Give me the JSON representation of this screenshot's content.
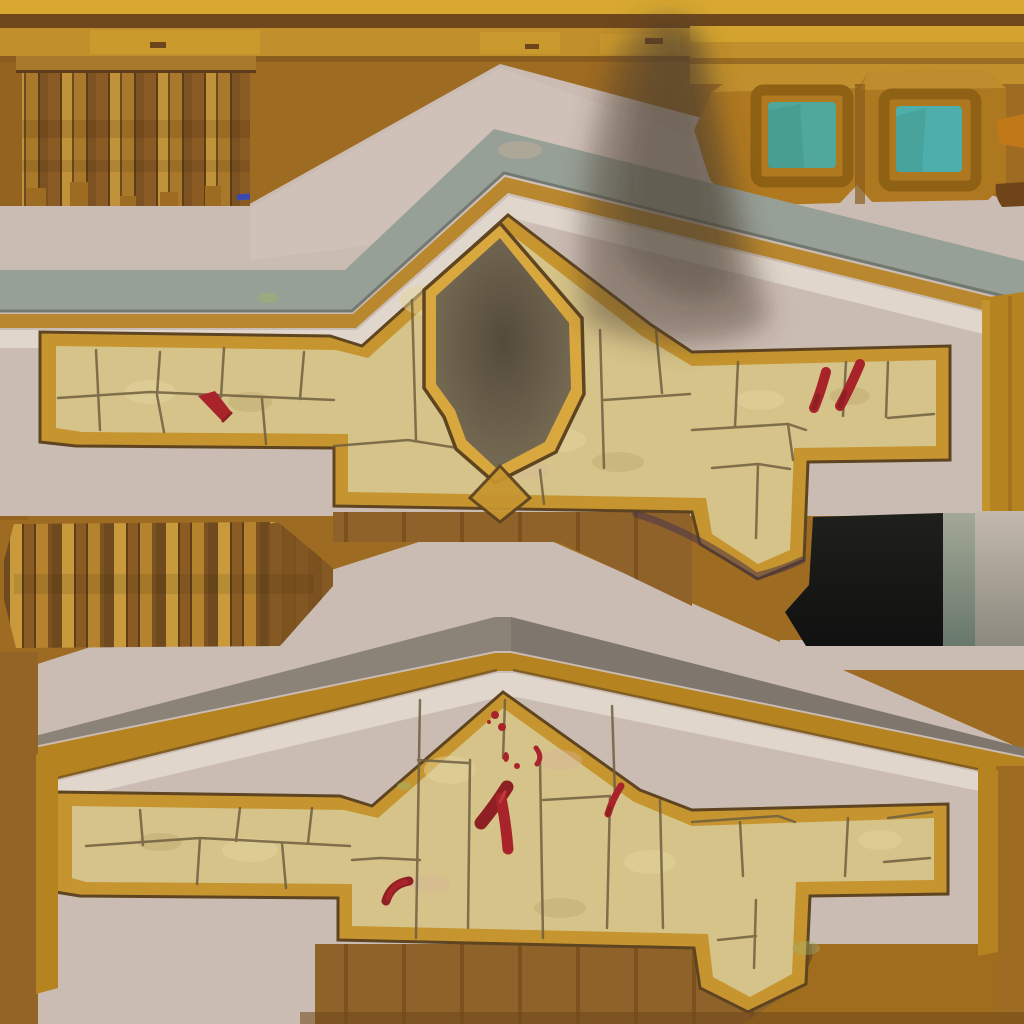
{
  "scene": {
    "description": "Hand-painted game environment texture atlas: top golden beam, vertical wooden plank strips, two chevron (peaked) plaster wall sections capped with gray stone and gold trim framing tan flagstone bands, a soot-blackened gold-bordered shield alcove with rising smoke, red blood smears on the flagstones, two chamfered wooden window panels with teal glass, a black rectangular opening with gray side bands, and a brown plank floor strip.",
    "parts": [
      "top-beam",
      "upper-left-plank-fence",
      "window-panel-left",
      "window-panel-right",
      "upper-wall-section",
      "upper-stone-band",
      "soot-shield-alcove",
      "smoke-plume",
      "black-opening",
      "middle-plank-strip",
      "lower-wall-section",
      "lower-stone-band",
      "blood-stains",
      "plank-floor"
    ],
    "blood_stain_count_upper": 3,
    "blood_stain_count_lower": 9,
    "window_count": 2
  },
  "palette": {
    "bg_brown": "#9E6B22",
    "bg_brown_dark": "#8A5C1E",
    "beam_gold_bright": "#D8A831",
    "beam_gold": "#C18F2B",
    "beam_seam": "#6F471C",
    "beam_shadow": "#8A5C1E",
    "plank_dark1": "#5E3D18",
    "plank_dark2": "#6E4A1E",
    "plank_mid1": "#8A5C24",
    "plank_mid2": "#A9792B",
    "plank_mid3": "#7C5220",
    "plank_gold1": "#C0923A",
    "plank_gold2": "#C89A3C",
    "plank_gold3": "#B5832D",
    "panel_ochre": "#B07920",
    "panel_ochre2": "#AE7820",
    "panel_recess": "#8E6114",
    "panel_highlight": "#D2A53C",
    "glass_teal_a": "#4FA89B",
    "glass_teal_b": "#4EAEAB",
    "glass_shade": "#3F9488",
    "wall_pink": "#CBBCB3",
    "wall_pink_light": "#D7CAC2",
    "cap_gray_green": "#97A097",
    "cap_gray_brown": "#8B8278",
    "cap_dark": "#736C62",
    "trim_gold": "#B9872E",
    "trim_ochre": "#B5831F",
    "band_white": "#E0D6CB",
    "frame_gold": "#C6952F",
    "frame_outline": "#5E4420",
    "stone": "#D5C389",
    "stone_light": "#E4D49C",
    "stone_dark": "#BCA96F",
    "stone_pink": "#D8B49A",
    "stone_green": "#9FB26B",
    "crack": "#6F5F40",
    "shield_gold": "#D8A83E",
    "soot_light": "#7E7259",
    "soot_dark": "#554B3B",
    "smoke": "#4A3C2F",
    "blood": "#A8242A",
    "blood_dark": "#8E1F22",
    "blood_bright": "#C23A3A",
    "black_rect_top": "#1F201C",
    "black_rect_bottom": "#101110",
    "band_green_top": "#A3A896",
    "band_green_bottom": "#67776B",
    "band_warm_top": "#C3B9AC",
    "band_warm_bottom": "#8C897E",
    "floor_brown": "#8F622A",
    "floor_sep": "#7B521E",
    "floor_plain": "#A06C1E",
    "left_strip": "#936426",
    "dark_bottom": "#70491A",
    "dark_knot": "#6E451A",
    "corner_dark": "#6E4418",
    "corner_orange": "#C07818",
    "purple_shadow": "#4B3548",
    "blue_artifact": "#3A49B0"
  }
}
